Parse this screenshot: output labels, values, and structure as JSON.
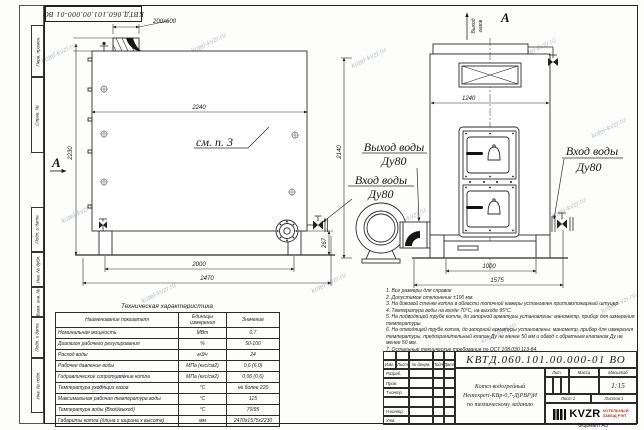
{
  "wm": {
    "text": "kotel-kvzr.ru"
  },
  "colors": {
    "line": "#2b2b2b",
    "logo_accent": "#c03a20",
    "watermark": "#b9c2cb"
  },
  "border": {
    "left_labels": [
      "Перв. примен.",
      "Справ. №",
      "Подп. и дата",
      "Инв. № дубл.",
      "Взам. инв. №",
      "Подп. и дата",
      "Инв. № подл."
    ],
    "format_note": "Формат А3"
  },
  "side": {
    "dim_chimney": "200х600",
    "dim_top": "2240",
    "dim_height": "2230",
    "see_note": "см. п. 3",
    "section_label": "А",
    "dim_skid": "2000",
    "dim_total": "2470",
    "dim_flange": "267"
  },
  "center": {
    "outlet_line1": "Выход воды",
    "outlet_line2": "Ду80",
    "inlet_line1": "Вход воды",
    "inlet_line2": "Ду80",
    "dim_height": "2140"
  },
  "front": {
    "gas_line1": "Выход",
    "gas_line2": "газов",
    "section_label": "А",
    "dim_width": "1240",
    "dim_base": "1000",
    "dim_total": "1575",
    "inlet_line1": "Вход воды",
    "inlet_line2": "Ду80"
  },
  "spec": {
    "title": "Техническая характеристика",
    "col_name": "Наименование показателя",
    "col_units": "Единицы измерения",
    "col_value": "Значение",
    "rows": [
      {
        "name": "Номинальная мощность",
        "units": "МВт",
        "value": "0,7"
      },
      {
        "name": "Диапазон рабочего регулирования",
        "units": "%",
        "value": "50-100"
      },
      {
        "name": "Расход воды",
        "units": "м3/ч",
        "value": "24"
      },
      {
        "name": "Рабочее давление воды",
        "units": "МПа (кгс/см2)",
        "value": "0,6 (6,0)"
      },
      {
        "name": "Гидравлическое сопротивление котла",
        "units": "МПа (кгс/см2)",
        "value": "0,06 (0,6)"
      },
      {
        "name": "Температура уходящих газов",
        "units": "°С",
        "value": "не более 220"
      },
      {
        "name": "Максимальная рабочая температура воды",
        "units": "°С",
        "value": "115"
      },
      {
        "name": "Температура воды (Вход/выход)",
        "units": "°С",
        "value": "70/95"
      },
      {
        "name": "Габариты котла (длина х ширина х высота)",
        "units": "мм",
        "value": "2470х1575х2230"
      }
    ]
  },
  "notes": [
    "1. Все размеры для справок",
    "2. Допустимое отклонение ±100 мм.",
    "3. На боковой стенке котла в области топочной камеры установлен противопожарный штуцер",
    "4. Температура воды на входе 70°С, на выходе 95°С.",
    "5. На подводящей трубе котла, до запорной арматуры установлены: манометр, прибор для измерения температуры.",
    "6. На отводящей трубе котла, до запорной арматуры установлены: манометр, прибор для измерения температуры, предохранительный клапан Ду не менее 50 мм и обвод с обратным клапаном Ду не менее 50 мм.",
    "7. Остальные технические требования по ОСТ 108.030.113-84."
  ],
  "tb": {
    "doc_number": "КВТД.060.101.00.000-01  ВО",
    "h_izm": "Изм.",
    "h_list": "Лист",
    "h_doc": "№ докум.",
    "h_sign": "Подп.",
    "h_date": "Дата",
    "r0": "Разраб.",
    "r1": "Пров.",
    "r2": "Т.контр.",
    "r3": "",
    "r4": "Н.контр.",
    "r5": "Утв.",
    "title_line1": "Котел водогрейный",
    "title_line2": "Heatexpert-КВр-0,7-Д(РВР)И",
    "title_line3": "по техническому заданию",
    "lit_label": "Лит.",
    "mass_label": "Масса",
    "scale_label": "Масштаб",
    "scale_value": "1:15",
    "sheet_label": "Лист 1",
    "sheets_label": "Листов 1",
    "logo_text": "KVZR",
    "company_line1": "КОТЕЛЬНЫЙ",
    "company_line2": "ЗАВОД РЭП"
  }
}
